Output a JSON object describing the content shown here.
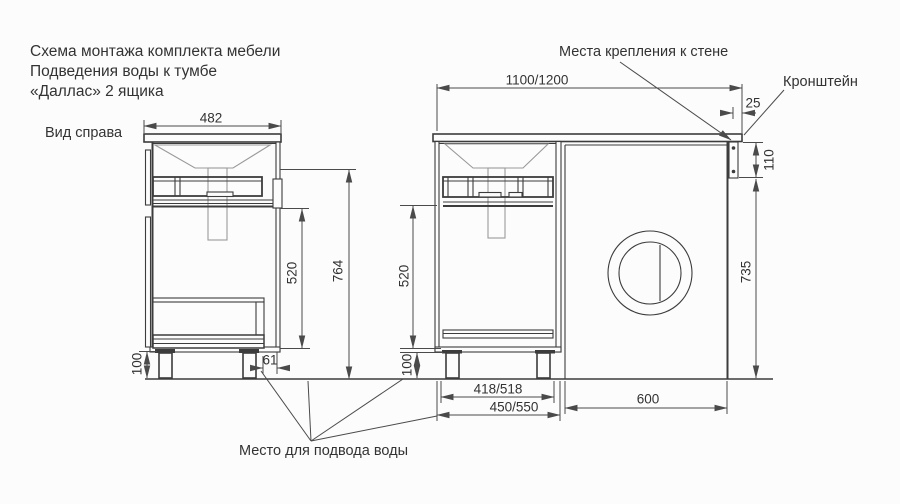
{
  "title_block": {
    "line1": "Схема монтажа комплекта мебели",
    "line2": "Подведения воды к тумбе",
    "line3": "«Даллас» 2 ящика"
  },
  "side_view": {
    "caption": "Вид справа",
    "dim_depth": "482",
    "dim_height_total": "764",
    "dim_height_open": "520",
    "dim_legs": "100",
    "dim_back_offset": "61"
  },
  "front_view": {
    "dim_length": "1100/1200",
    "dim_bracket_offset": "25",
    "dim_bracket_height": "110",
    "dim_wm_clearance": "735",
    "dim_open_height": "520",
    "dim_legs": "100",
    "dim_legs_span": "418/518",
    "dim_cabinet_width": "450/550",
    "dim_wm_width": "600"
  },
  "annotations": {
    "wall_mount_points": "Места крепления к стене",
    "bracket": "Кронштейн",
    "water_supply": "Место для подвода воды"
  },
  "colors": {
    "line": "#3c3c3c",
    "light_line": "#9a9a9a",
    "text": "#333333",
    "background": "#fcfcfc"
  }
}
